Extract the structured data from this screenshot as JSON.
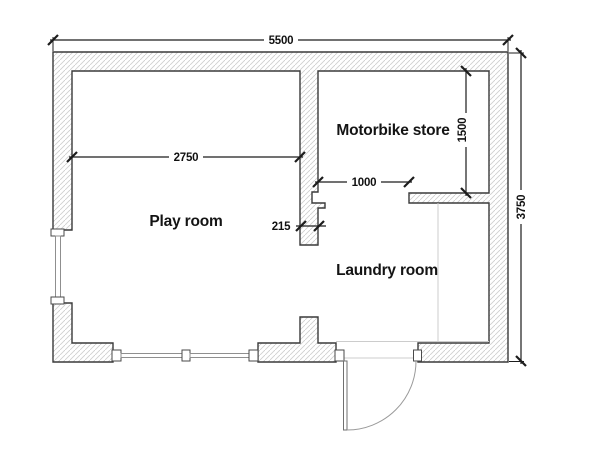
{
  "plan": {
    "title": "floor-plan",
    "rooms": [
      {
        "name": "Play room"
      },
      {
        "name": "Motorbike store"
      },
      {
        "name": "Laundry room"
      }
    ],
    "dimensions": {
      "overall_width_mm": "5500",
      "overall_depth_mm": "3750",
      "play_room_width_mm": "2750",
      "motorbike_store_depth_mm": "1500",
      "opening_width_mm": "1000",
      "wall_thickness_mm": "215"
    },
    "colors": {
      "background": "#ffffff",
      "wall_outline": "#3a3a3a",
      "wall_hatch": "#cfcfcf",
      "dimension_line": "#1c1c1c",
      "window_line": "#8f8f8f",
      "faint_line": "#cccccc"
    }
  }
}
